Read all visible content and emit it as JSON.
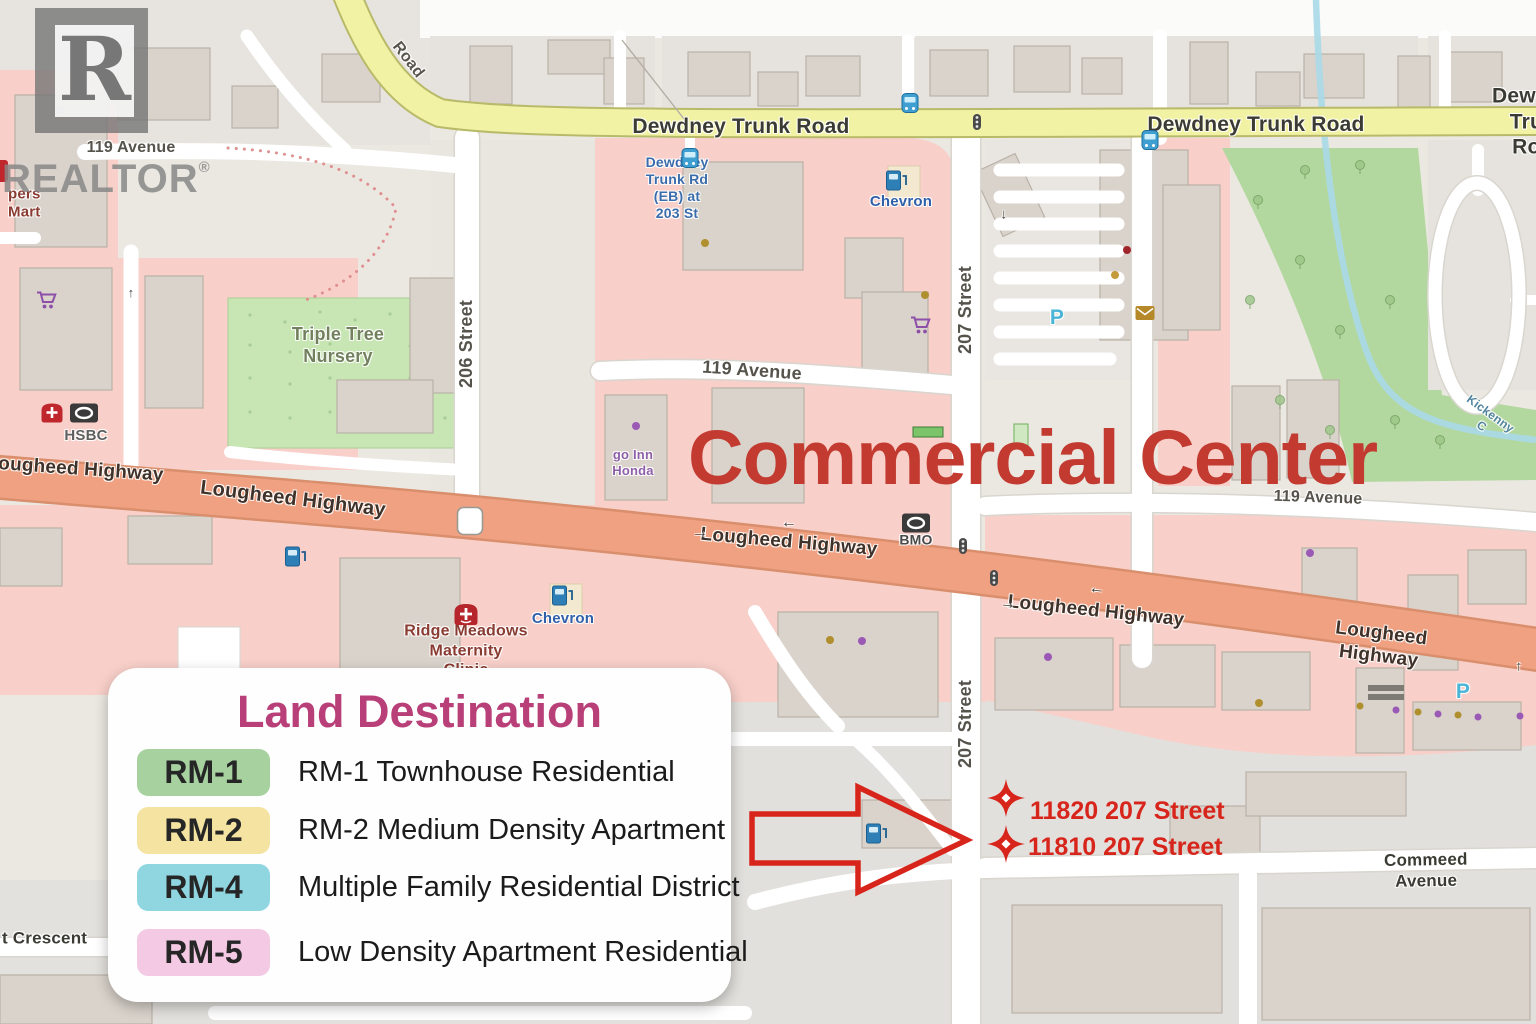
{
  "colors": {
    "annotation_red": "#d8251c",
    "title_red": "#c23a30",
    "legend_title_magenta": "#b83f78",
    "watermark_gray": "#878787",
    "road_yellow": "#f1f2a4",
    "highway_salmon": "#f0a182",
    "zone_pink": "#f8cfc9",
    "park_green": "#b3d89f"
  },
  "watermark": {
    "logo_letter": "R",
    "brand": "REALTOR",
    "registered": "®"
  },
  "annotations": {
    "title": "Commercial Center",
    "address_1": "11820 207 Street",
    "address_2": "11810 207 Street"
  },
  "legend": {
    "title": "Land Destination",
    "items": [
      {
        "code": "RM-1",
        "color": "#a7d2a0",
        "label": "RM-1 Townhouse Residential"
      },
      {
        "code": "RM-2",
        "color": "#f4e3a1",
        "label": "RM-2 Medium Density Apartment"
      },
      {
        "code": "RM-4",
        "color": "#8fd6e1",
        "label": "Multiple Family Residential District"
      },
      {
        "code": "RM-5",
        "color": "#f3c9e3",
        "label": "Low Density Apartment Residential"
      }
    ]
  },
  "map": {
    "labels": [
      {
        "text": "Road",
        "x": 408,
        "y": 60,
        "size": 16,
        "color": "#57554c",
        "rotate": 52
      },
      {
        "text": "Dewdney Trunk Road",
        "x": 741,
        "y": 127,
        "size": 21,
        "color": "#3b3b34"
      },
      {
        "text": "Dewdney Trunk Road",
        "x": 1256,
        "y": 125,
        "size": 21,
        "color": "#3b3b34"
      },
      {
        "text": "Dewdney Trunk Road",
        "x": 1492,
        "y": 122,
        "size": 21,
        "color": "#3b3b34",
        "align": "left"
      },
      {
        "text": "119 Avenue",
        "x": 131,
        "y": 148,
        "size": 16,
        "color": "#55534b"
      },
      {
        "text": "119 Avenue",
        "x": 752,
        "y": 371,
        "size": 18,
        "color": "#55534b",
        "rotate": 4
      },
      {
        "text": "119 Avenue",
        "x": 1318,
        "y": 498,
        "size": 16,
        "color": "#55534b",
        "rotate": 2
      },
      {
        "text": "206 Street",
        "x": 467,
        "y": 344,
        "size": 18,
        "color": "#55534b",
        "rotate": -90
      },
      {
        "text": "207 Street",
        "x": 966,
        "y": 310,
        "size": 18,
        "color": "#55534b",
        "rotate": -90
      },
      {
        "text": "207 Street",
        "x": 966,
        "y": 724,
        "size": 18,
        "color": "#55534b",
        "rotate": -90
      },
      {
        "text": "Lougheed Highway",
        "x": 75,
        "y": 469,
        "size": 19,
        "color": "#403229",
        "rotate": 4
      },
      {
        "text": "Lougheed Highway",
        "x": 293,
        "y": 499,
        "size": 20,
        "color": "#403229",
        "rotate": 7
      },
      {
        "text": "Lougheed Highway",
        "x": 789,
        "y": 542,
        "size": 19,
        "color": "#403229",
        "rotate": 5
      },
      {
        "text": "Lougheed Highway",
        "x": 1096,
        "y": 611,
        "size": 19,
        "color": "#403229",
        "rotate": 6
      },
      {
        "text": "Lougheed Highway",
        "x": 1380,
        "y": 645,
        "size": 19,
        "color": "#403229",
        "rotate": 7
      },
      {
        "text": "Commeed Avenue",
        "x": 1426,
        "y": 871,
        "size": 17,
        "color": "#3b3b34",
        "rotate": -1
      },
      {
        "text": "t Crescent",
        "x": 2,
        "y": 939,
        "size": 17,
        "color": "#3b3b34",
        "align": "left"
      },
      {
        "text": "Triple Tree\nNursery",
        "x": 338,
        "y": 346,
        "size": 18,
        "color": "#72805e"
      },
      {
        "text": "Dewdney\nTrunk Rd\n(EB) at\n203 St",
        "x": 677,
        "y": 188,
        "size": 14,
        "color": "#3a6cab"
      },
      {
        "text": "Chevron",
        "x": 901,
        "y": 202,
        "size": 15,
        "color": "#2f5fa8"
      },
      {
        "text": "Chevron",
        "x": 563,
        "y": 619,
        "size": 15,
        "color": "#2f5fa8"
      },
      {
        "text": "HSBC",
        "x": 86,
        "y": 436,
        "size": 15,
        "color": "#5f5f5f"
      },
      {
        "text": "BMO",
        "x": 916,
        "y": 540,
        "size": 14,
        "color": "#4a4a4a"
      },
      {
        "text": "go Inn\nHonda",
        "x": 633,
        "y": 463,
        "size": 13,
        "color": "#8d5fa8"
      },
      {
        "text": "Ridge Meadows\nMaternity\nClinic",
        "x": 466,
        "y": 651,
        "size": 16,
        "color": "#8a3c33"
      },
      {
        "text": "pers\nMart",
        "x": 8,
        "y": 204,
        "size": 15,
        "color": "#8a3c33",
        "align": "left"
      },
      {
        "text": "Kickenny C",
        "x": 1486,
        "y": 420,
        "size": 12,
        "color": "#50859d",
        "rotate": 36
      },
      {
        "text": "7",
        "x": 470,
        "y": 521,
        "size": 14,
        "color": "#3a3a3a",
        "weight": 700
      },
      {
        "text": "P",
        "x": 1057,
        "y": 318,
        "size": 21,
        "color": "#4ab5d6",
        "weight": 700
      },
      {
        "text": "P",
        "x": 1463,
        "y": 692,
        "size": 21,
        "color": "#4ab5d6",
        "weight": 700
      },
      {
        "text": "→",
        "x": 700,
        "y": 533,
        "size": 16,
        "color": "#403a33"
      },
      {
        "text": "←",
        "x": 789,
        "y": 523,
        "size": 16,
        "color": "#403a33"
      },
      {
        "text": "→",
        "x": 1008,
        "y": 604,
        "size": 16,
        "color": "#403a33",
        "rotate": 6
      },
      {
        "text": "←",
        "x": 1097,
        "y": 589,
        "size": 16,
        "color": "#403a33",
        "rotate": 6
      },
      {
        "text": "↓",
        "x": 1004,
        "y": 214,
        "size": 14,
        "color": "#4a4a44"
      },
      {
        "text": "↑",
        "x": 1519,
        "y": 666,
        "size": 14,
        "color": "#4a4a44"
      },
      {
        "text": "↑",
        "x": 131,
        "y": 293,
        "size": 13,
        "color": "#4a4a44"
      }
    ],
    "icons": [
      {
        "name": "bus",
        "x": 690,
        "y": 158
      },
      {
        "name": "bus",
        "x": 910,
        "y": 103
      },
      {
        "name": "bus",
        "x": 1150,
        "y": 140
      },
      {
        "name": "traffic-light",
        "x": 977,
        "y": 122
      },
      {
        "name": "traffic-light",
        "x": 963,
        "y": 546
      },
      {
        "name": "traffic-light",
        "x": 994,
        "y": 578
      },
      {
        "name": "gas-pump",
        "x": 897,
        "y": 180
      },
      {
        "name": "gas-pump",
        "x": 563,
        "y": 595
      },
      {
        "name": "gas-pump",
        "x": 296,
        "y": 556
      },
      {
        "name": "gas-pump",
        "x": 877,
        "y": 833
      },
      {
        "name": "shopping-cart",
        "x": 47,
        "y": 300
      },
      {
        "name": "shopping-cart",
        "x": 921,
        "y": 325
      },
      {
        "name": "envelope",
        "x": 1145,
        "y": 313
      },
      {
        "name": "pharmacy",
        "x": 52,
        "y": 413
      },
      {
        "name": "bank-logo",
        "x": 84,
        "y": 413
      },
      {
        "name": "bank-logo",
        "x": 916,
        "y": 523
      },
      {
        "name": "clinic",
        "x": 466,
        "y": 614
      },
      {
        "name": "highway-shield",
        "x": 470,
        "y": 521
      }
    ]
  }
}
